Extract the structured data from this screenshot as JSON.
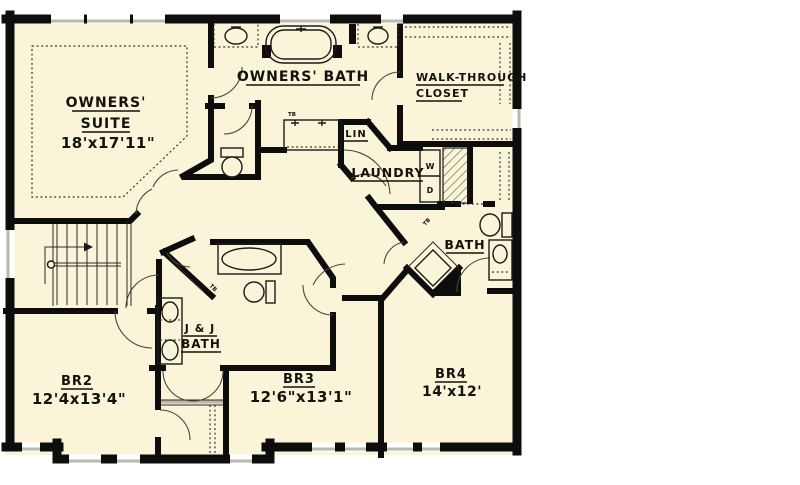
{
  "plan": {
    "rooms": {
      "owners_suite": {
        "line1": "OWNERS'",
        "line2": "SUITE",
        "dims": "18'x17'11\""
      },
      "owners_bath": {
        "label": "OWNERS' BATH"
      },
      "walk_through_closet": {
        "line1": "WALK-THROUGH",
        "line2": "CLOSET"
      },
      "linen_closet": {
        "label": "LIN"
      },
      "laundry": {
        "label": "LAUNDRY"
      },
      "bath": {
        "label": "BATH"
      },
      "jack_and_jill_bath": {
        "line1": "J & J",
        "line2": "BATH"
      },
      "bedroom2": {
        "label": "BR2",
        "dims": "12'4x13'4\""
      },
      "bedroom3": {
        "label": "BR3",
        "dims": "12'6\"x13'1\""
      },
      "bedroom4": {
        "label": "BR4",
        "dims": "14'x12'"
      }
    },
    "appliances": {
      "washer": "W",
      "dryer": "D"
    },
    "fixtures": {
      "towel_bar": "TB"
    },
    "colors": {
      "floor": "#faf5d8",
      "walls": "#0d0d0d",
      "window_frame": "#b9b9ad",
      "page_background": "#ffffff"
    }
  }
}
